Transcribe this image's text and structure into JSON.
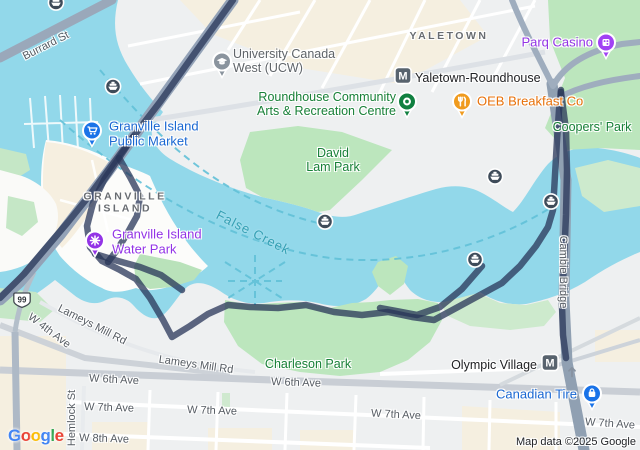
{
  "map": {
    "attribution": "Map data ©2025 Google",
    "google_logo": [
      {
        "ch": "G",
        "color": "#4285F4"
      },
      {
        "ch": "o",
        "color": "#EA4335"
      },
      {
        "ch": "o",
        "color": "#FBBC05"
      },
      {
        "ch": "g",
        "color": "#4285F4"
      },
      {
        "ch": "l",
        "color": "#34A853"
      },
      {
        "ch": "e",
        "color": "#EA4335"
      }
    ],
    "colors": {
      "route": "rgba(40,53,88,0.75)",
      "water": "#92d8ea",
      "park": "#bce6bd",
      "park_pale": "#cdeacd",
      "land": "#eef0f1",
      "buildings": "#f5efe0",
      "bridge_road": "#93a2b7",
      "poi_blue": "#1967d2",
      "poi_green": "#188038",
      "poi_orange": "#e8710a",
      "poi_purple": "#9334e6",
      "water_label": "#35a0b4",
      "ferry_dash": "#62c1d8"
    },
    "labels": [
      {
        "name": "label-burrard-st",
        "cls": "street",
        "text": "Burrard St",
        "x": 46,
        "y": 46,
        "rot": -27,
        "align": "center",
        "i": false
      },
      {
        "name": "label-university-canada-west",
        "cls": "poi-muted",
        "lines": [
          "University Canada",
          "West (UCW)"
        ],
        "x": 233,
        "y": 61,
        "rot": 0,
        "align": "left",
        "i": true
      },
      {
        "name": "label-yaletown",
        "cls": "district",
        "text": "YALETOWN",
        "x": 449,
        "y": 37,
        "rot": 0,
        "align": "center",
        "i": false
      },
      {
        "name": "label-parq-casino",
        "cls": "poi-purple",
        "text": "Parq Casino",
        "x": 593,
        "y": 43,
        "rot": 0,
        "align": "right",
        "i": true
      },
      {
        "name": "label-yaletown-roundhouse-station",
        "cls": "poi-dark",
        "text": "Yaletown-Roundhouse",
        "x": 415,
        "y": 78,
        "rot": 0,
        "align": "left",
        "i": true
      },
      {
        "name": "label-roundhouse-centre",
        "cls": "poi-green",
        "lines": [
          "Roundhouse Community",
          "Arts & Recreation Centre"
        ],
        "x": 396,
        "y": 104,
        "rot": 0,
        "align": "right",
        "i": true
      },
      {
        "name": "label-oeb-breakfast",
        "cls": "poi-orange",
        "text": "OEB Breakfast Co",
        "x": 477,
        "y": 102,
        "rot": 0,
        "align": "left",
        "i": true
      },
      {
        "name": "label-coopers-park",
        "cls": "poi-green",
        "text": "Coopers' Park",
        "x": 592,
        "y": 127,
        "rot": 0,
        "align": "center",
        "i": true
      },
      {
        "name": "label-public-market",
        "cls": "poi-blue",
        "lines": [
          "Granville Island",
          "Public Market"
        ],
        "x": 109,
        "y": 134,
        "rot": 0,
        "align": "left",
        "i": true
      },
      {
        "name": "label-granville-island",
        "cls": "district",
        "lines": [
          "GRANVILLE",
          "ISLAND"
        ],
        "x": 125,
        "y": 203,
        "rot": 0,
        "align": "center",
        "i": false
      },
      {
        "name": "label-water-park",
        "cls": "poi-purple",
        "lines": [
          "Granville Island",
          "Water Park"
        ],
        "x": 112,
        "y": 242,
        "rot": 0,
        "align": "left",
        "i": true
      },
      {
        "name": "label-david-lam-park",
        "cls": "poi-green",
        "lines": [
          "David",
          "Lam Park"
        ],
        "x": 333,
        "y": 160,
        "rot": 0,
        "align": "center",
        "i": true
      },
      {
        "name": "label-false-creek",
        "cls": "water-label",
        "text": "False Creek",
        "x": 253,
        "y": 233,
        "rot": 27,
        "align": "center",
        "i": false
      },
      {
        "name": "label-cambie-bridge",
        "cls": "street",
        "text": "Cambie Bridge",
        "x": 563,
        "y": 272,
        "rot": 90,
        "align": "center",
        "i": false
      },
      {
        "name": "label-olympic-village-station",
        "cls": "poi-dark",
        "text": "Olympic Village",
        "x": 537,
        "y": 365,
        "rot": 0,
        "align": "right",
        "i": true
      },
      {
        "name": "label-canadian-tire",
        "cls": "poi-blue",
        "text": "Canadian Tire",
        "x": 577,
        "y": 395,
        "rot": 0,
        "align": "right",
        "i": true
      },
      {
        "name": "label-w4th-ave",
        "cls": "street",
        "text": "W 4th Ave",
        "x": 49,
        "y": 331,
        "rot": 37,
        "align": "center",
        "i": false
      },
      {
        "name": "label-lameys-mill-rd-1",
        "cls": "street",
        "text": "Lameys Mill Rd",
        "x": 92,
        "y": 325,
        "rot": 27,
        "align": "center",
        "i": false
      },
      {
        "name": "label-lameys-mill-rd-2",
        "cls": "street",
        "text": "Lameys Mill Rd",
        "x": 196,
        "y": 365,
        "rot": 8,
        "align": "center",
        "i": false
      },
      {
        "name": "label-charleson-park",
        "cls": "poi-green",
        "text": "Charleson Park",
        "x": 308,
        "y": 364,
        "rot": 0,
        "align": "center",
        "i": true
      },
      {
        "name": "label-w6th-ave-1",
        "cls": "street",
        "text": "W 6th Ave",
        "x": 114,
        "y": 380,
        "rot": 3,
        "align": "center",
        "i": false
      },
      {
        "name": "label-w6th-ave-2",
        "cls": "street",
        "text": "W 6th Ave",
        "x": 296,
        "y": 383,
        "rot": 2,
        "align": "center",
        "i": false
      },
      {
        "name": "label-w7th-ave-1",
        "cls": "street",
        "text": "W 7th Ave",
        "x": 109,
        "y": 408,
        "rot": 2,
        "align": "center",
        "i": false
      },
      {
        "name": "label-w7th-ave-2",
        "cls": "street",
        "text": "W 7th Ave",
        "x": 212,
        "y": 411,
        "rot": 2,
        "align": "center",
        "i": false
      },
      {
        "name": "label-w7th-ave-3",
        "cls": "street",
        "text": "W 7th Ave",
        "x": 396,
        "y": 415,
        "rot": 3,
        "align": "center",
        "i": false
      },
      {
        "name": "label-w7th-ave-4",
        "cls": "street",
        "text": "W 7th Ave",
        "x": 610,
        "y": 424,
        "rot": 4,
        "align": "center",
        "i": false
      },
      {
        "name": "label-w8th-ave",
        "cls": "street",
        "text": "W 8th Ave",
        "x": 104,
        "y": 439,
        "rot": 2,
        "align": "center",
        "i": false
      },
      {
        "name": "label-hemlock-st",
        "cls": "street",
        "text": "Hemlock St",
        "x": 72,
        "y": 418,
        "rot": -90,
        "align": "center",
        "i": false
      }
    ],
    "markers": [
      {
        "name": "ferry-stop-icon",
        "glyph": "ferry",
        "x": 56,
        "y": 5
      },
      {
        "name": "ferry-stop-icon",
        "glyph": "ferry",
        "x": 113,
        "y": 89
      },
      {
        "name": "ferry-stop-icon",
        "glyph": "ferry",
        "x": 325,
        "y": 224
      },
      {
        "name": "ferry-stop-icon",
        "glyph": "ferry",
        "x": 495,
        "y": 179
      },
      {
        "name": "ferry-stop-icon",
        "glyph": "ferry",
        "x": 551,
        "y": 204
      },
      {
        "name": "ferry-stop-icon",
        "glyph": "ferry",
        "x": 475,
        "y": 262
      },
      {
        "name": "shopping-cart-icon",
        "glyph": "cart",
        "bg": "#1a73e8",
        "pin": true,
        "x": 92,
        "y": 131
      },
      {
        "name": "water-park-icon",
        "glyph": "splash",
        "bg": "#9334e6",
        "pin": true,
        "x": 95,
        "y": 241
      },
      {
        "name": "university-icon",
        "glyph": "cap",
        "bg": "#8a949e",
        "pin": true,
        "x": 222,
        "y": 62
      },
      {
        "name": "community-centre-icon",
        "glyph": "ring",
        "bg": "#108040",
        "pin": true,
        "x": 407,
        "y": 102
      },
      {
        "name": "restaurant-icon",
        "glyph": "utensils",
        "bg": "#f09b1e",
        "pin": true,
        "x": 462,
        "y": 102
      },
      {
        "name": "casino-dice-icon",
        "glyph": "dice",
        "bg": "#a142f4",
        "pin": true,
        "x": 606,
        "y": 43
      },
      {
        "name": "shopping-bag-icon",
        "glyph": "bag",
        "bg": "#1a73e8",
        "pin": true,
        "x": 592,
        "y": 394
      },
      {
        "name": "metro-station-icon",
        "glyph": "M",
        "x": 403,
        "y": 78
      },
      {
        "name": "metro-station-icon",
        "glyph": "M",
        "x": 550,
        "y": 365
      },
      {
        "name": "highway-99-shield",
        "glyph": "99",
        "x": 22,
        "y": 303
      },
      {
        "name": "one-way-arrow-icon",
        "glyph": "arrow",
        "x": 572,
        "y": 374
      }
    ]
  }
}
